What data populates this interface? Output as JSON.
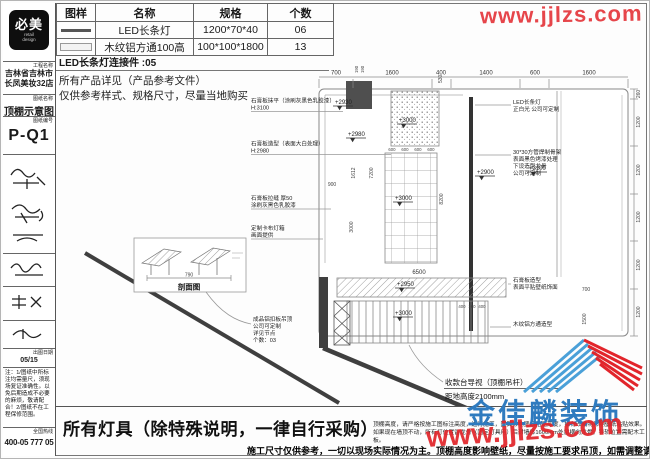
{
  "sidebar": {
    "logo": {
      "title": "必美",
      "subtitle1": "retail",
      "subtitle2": "design"
    },
    "project": {
      "label": "工程名称",
      "line1": "吉林省吉林市",
      "line2": "长凤美妆32店"
    },
    "sheet_name": {
      "label": "图纸名称",
      "value": "顶棚示意图"
    },
    "sheet_no": {
      "label": "图纸编号",
      "value": "P-Q1"
    },
    "date": {
      "label": "出图日期",
      "value": "05/15"
    },
    "note": "注：1/图纸中所标注均需量尺，须现场复证准确性。以免后期造成不必要的麻烦，敬请配合！2/图纸不在工程保修范围。",
    "hotline": {
      "label": "全国热线",
      "value": "400-05 777 05"
    }
  },
  "parts_table": {
    "headers": [
      "图样",
      "名称",
      "规格",
      "个数"
    ],
    "rows": [
      {
        "name": "LED长条灯",
        "spec": "1200*70*40",
        "qty": "06"
      },
      {
        "name": "木纹铝方通100高",
        "spec": "100*100*1800",
        "qty": "13"
      }
    ],
    "connector_note": "LED长条灯连接件 :05",
    "remark1": "所有产品详见（产品参考文件）",
    "remark2": "仅供参考样式、规格尺寸，尽量当地购买"
  },
  "plan": {
    "left_labels": [
      {
        "l1": "石膏板抹平（涂刷灰黑色乳胶漆）",
        "l2": "H:3100"
      },
      {
        "l1": "石膏板造型（表面大白处理）",
        "l2": "H:2980"
      },
      {
        "l1": "石膏板拉缝 厚50",
        "l2": "涂刷灰黑色乳胶漆"
      },
      {
        "l1": "定制卡布灯箱",
        "l2": "画面提供"
      },
      {
        "l1": "成品铝扣板吊顶",
        "l2": "公司可定制",
        "l3": "详见节点",
        "l4": "个数：03"
      }
    ],
    "right_labels": [
      {
        "l1": "LED长条灯",
        "l2": "正白光 公司可定制"
      },
      {
        "l1": "30*30方管焊制骨架",
        "l2": "表面黑色烤漆处理",
        "l3": "下设造型龙骨",
        "l4": "公司可定制"
      },
      {
        "l1": "石膏板造型",
        "l2": "表面平贴壁纸饰面"
      },
      {
        "l1": "木纹铝方通造型"
      }
    ],
    "elevations": {
      "e1": "+2930",
      "e2": "+2980",
      "e3": "+3000",
      "e4": "+3000",
      "e5": "+3100",
      "e6": "+2900",
      "e7": "+2950",
      "e8": "+3000"
    },
    "dims": {
      "top": [
        "700",
        "1600",
        "400",
        "1400",
        "600",
        "1600"
      ],
      "right": [
        "260",
        "1200",
        "1200",
        "1200",
        "1200",
        "1200"
      ],
      "grid": [
        "600",
        "600",
        "600",
        "600"
      ],
      "v530": "530",
      "r190a": "190",
      "r190b": "190",
      "v1612": "1612",
      "v7200": "7200",
      "h900": "900",
      "v3000": "3000",
      "v8200": "8200",
      "band6500": "6500",
      "lou1": "400",
      "lou2": "100",
      "lou3": "400",
      "v1500": "1500",
      "h700": "700"
    },
    "inset": {
      "caption": "剖面图",
      "dim": "790"
    },
    "cashier": {
      "line1": "收款台导视（顶棚吊杆）",
      "line2": "距地高度2100mm"
    }
  },
  "footer": {
    "lamp_note": "所有灯具（除特殊说明，一律自行采购）",
    "small1": "顶棚高度，请严格按施工图标注高度，进行施工，因其影响壁纸粘贴高度，如有改动将影响壁纸粘贴效果。",
    "small2": "如果现在墙顶不动，所有灯位置留龙骨（固定灯具用）后封墙体1600mm处留横向龙骨，导轨位置需配木工板。",
    "bold": "施工尺寸仅供参考，一切以现场实际情况为主。顶棚高度影响壁纸，尽量按施工要求吊顶，如需调整请联系施工指导。"
  },
  "branding": {
    "company": "金佳麟装饰",
    "watermark_bottom": "www.jjlzs.com",
    "watermark_top": "www.jjlzs.com"
  },
  "colors": {
    "red": "#e2252b",
    "blue": "#2f7bbf",
    "ink": "#1a1a1a",
    "line": "#777777"
  }
}
